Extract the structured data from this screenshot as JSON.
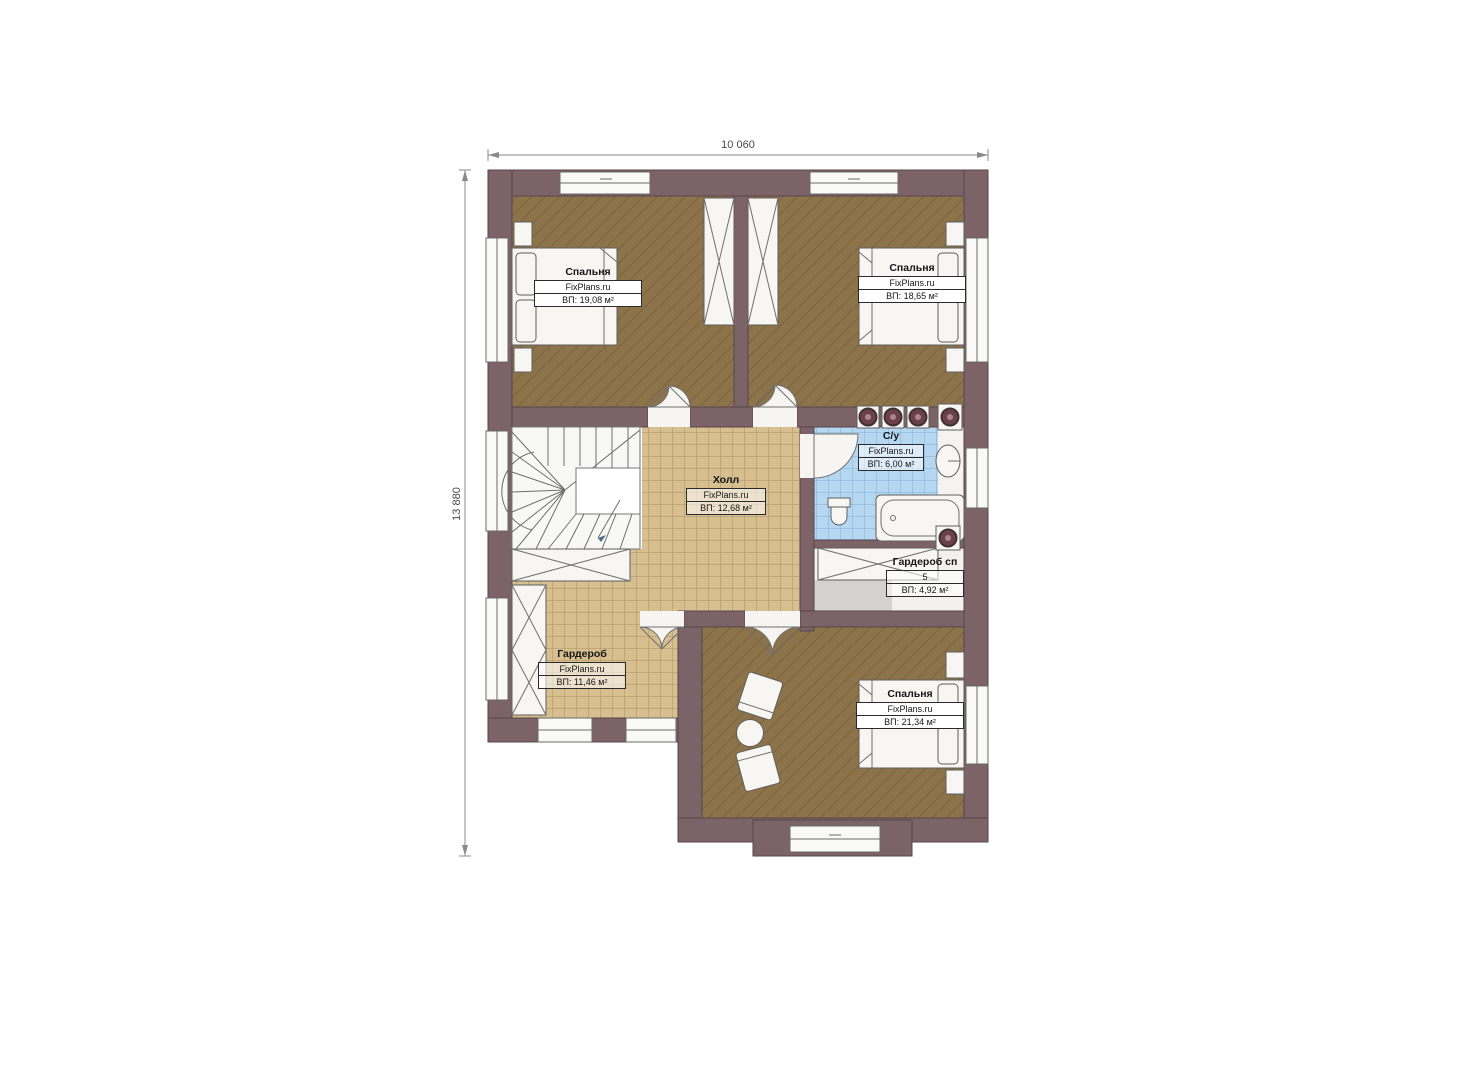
{
  "title": "Second floor plan",
  "dimensions": {
    "width_label": "10 060",
    "height_label": "13 880"
  },
  "rooms": [
    {
      "id": "bedroom-1",
      "name": "Спальня",
      "brand": "FixPlans.ru",
      "area": "ВП: 19,08 м²"
    },
    {
      "id": "bedroom-2",
      "name": "Спальня",
      "brand": "FixPlans.ru",
      "area": "ВП: 18,65 м²"
    },
    {
      "id": "hall",
      "name": "Холл",
      "brand": "FixPlans.ru",
      "area": "ВП: 12,68 м²"
    },
    {
      "id": "bathroom",
      "name": "С/у",
      "brand": "FixPlans.ru",
      "area": "ВП: 6,00 м²"
    },
    {
      "id": "wardrobe-master",
      "name": "Гардероб сп",
      "brand": "5",
      "area": "ВП: 4,92 м²"
    },
    {
      "id": "wardrobe",
      "name": "Гардероб",
      "brand": "FixPlans.ru",
      "area": "ВП: 11,46 м²"
    },
    {
      "id": "bedroom-3",
      "name": "Спальня",
      "brand": "FixPlans.ru",
      "area": "ВП: 21,34 м²"
    }
  ],
  "colors": {
    "wall": "#7c6367",
    "bedroom_floor": "#8d7349",
    "tile_floor": "#d7bf90",
    "bathroom_floor": "#b6d7f2",
    "wardrobe_sp_floor": "#d4d2cf",
    "background": "#ffffff"
  }
}
